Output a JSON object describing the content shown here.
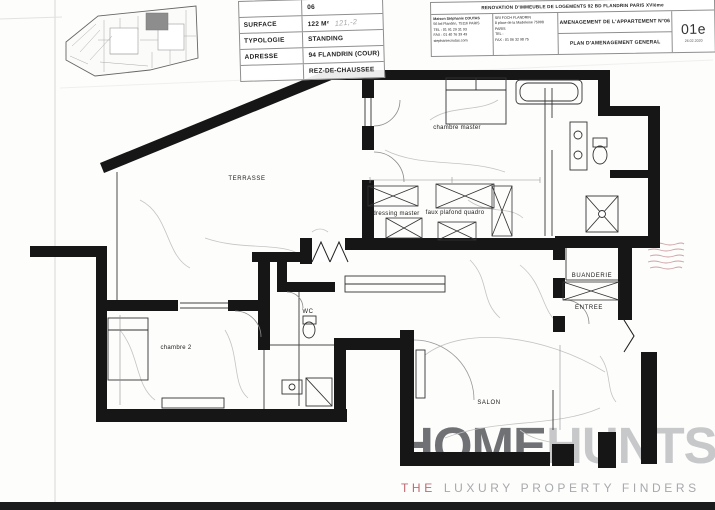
{
  "sheet": {
    "revision": "01e",
    "date": "26.02.2020",
    "project_title": "RENOVATION D'IMMEUBLE DE LOGEMENTS 92 BD FLANDRIN PARIS XVIème",
    "drawing_title_1": "AMENAGEMENT DE L'APPARTEMENT N°06",
    "drawing_title_2": "PLAN D'AMENAGEMENT GENERAL"
  },
  "title_block": {
    "apartment_number": "06",
    "surface_label": "SURFACE",
    "surface_value": "122 M²",
    "surface_note": "121,-2",
    "typologie_label": "TYPOLOGIE",
    "typologie_value": "STANDING",
    "adresse_label": "ADRESSE",
    "adresse_value": "94 FLANDRIN (COUR)",
    "niveau_value": "REZ-DE-CHAUSSEE"
  },
  "architect_block": {
    "line1": "Maison Stéphanie COUTAS",
    "line2": "56 bd Flandrin, 75116 PARIS",
    "line3": "TEL : 01 91 29 31 93",
    "line4": "FAX : 01 40 76 39 49",
    "line5": "stephaniecoutas.com"
  },
  "client_block": {
    "line1": "SRI FOCH FLANDRIN",
    "line2": "8 place de la Madeleine 75008 PARIS",
    "line3": "TEL :",
    "line4": "FAX : 01 06 32 98 75"
  },
  "plan": {
    "rooms": [
      {
        "id": "terrasse",
        "label": "TERRASSE"
      },
      {
        "id": "chambre-master",
        "label": "chambre master"
      },
      {
        "id": "dressing-master",
        "label": "dressing master"
      },
      {
        "id": "faux-plafond-quadro",
        "label": "faux plafond quadro"
      },
      {
        "id": "buanderie",
        "label": "BUANDERIE"
      },
      {
        "id": "entree",
        "label": "ENTREE"
      },
      {
        "id": "wc",
        "label": "WC"
      },
      {
        "id": "chambre-2",
        "label": "chambre 2"
      },
      {
        "id": "salon",
        "label": "SALON"
      }
    ]
  },
  "logo": {
    "word1": "HOME",
    "word2": "HUNTS",
    "tagline_the": "THE",
    "tagline_rest": "LUXURY PROPERTY FINDERS",
    "color_word1": "#6f7174",
    "color_word2": "#c7c8ca",
    "color_the": "#c16a72",
    "color_rest": "#a7a9ac"
  }
}
